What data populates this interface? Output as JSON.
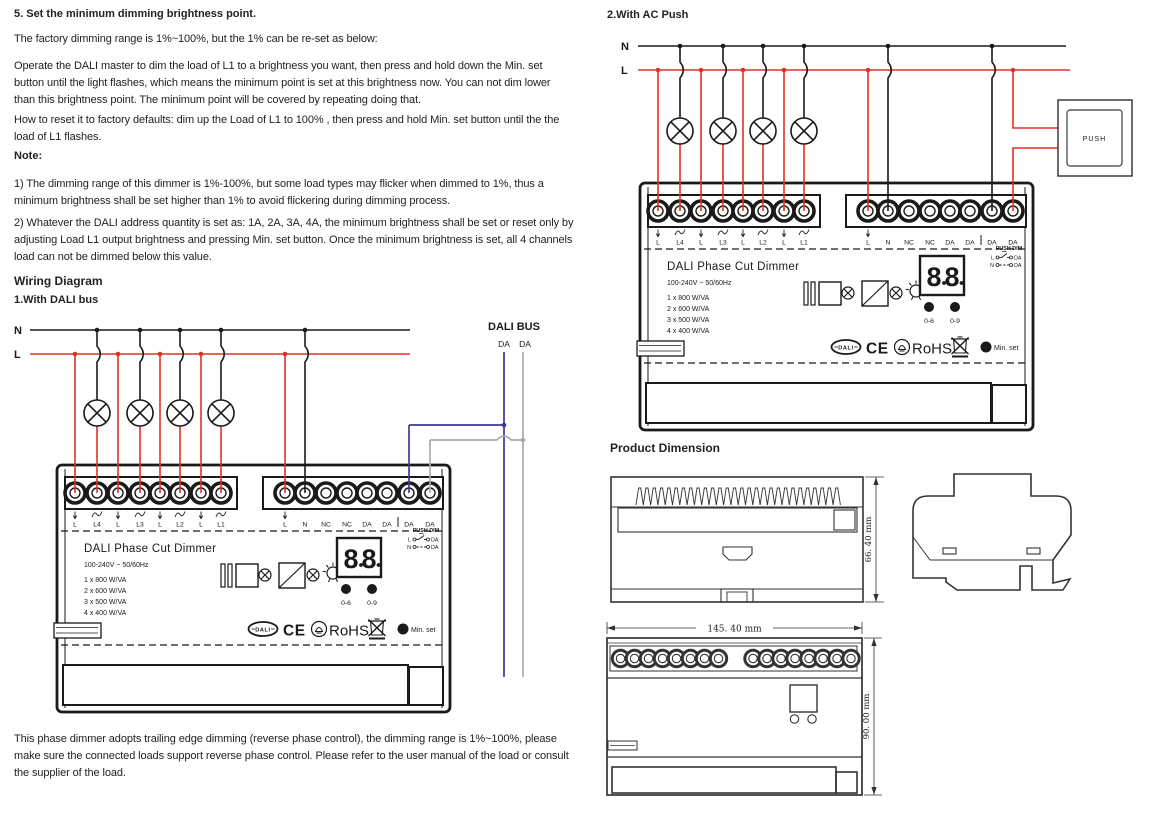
{
  "section5": {
    "heading": "5. Set the minimum dimming brightness point.",
    "para1": "The factory dimming range is 1%~100%, but the 1% can be re-set as below:",
    "para2": "Operate the DALI master to dim the load of L1 to a brightness you want, then press and hold down the Min. set button until the light flashes, which means the minimum point is set at this brightness now. You can not dim lower than this brightness point. The minimum point will be covered by repeating doing that.",
    "para3": "How to reset it to factory defaults: dim up the Load of L1 to 100% , then press and hold Min. set button until the the load of L1 flashes.",
    "note_heading": "Note:",
    "note1": "1) The dimming range of this dimmer is 1%-100%, but some load types may flicker when dimmed to 1%, thus a minimum brightness shall be set higher than 1% to avoid flickering during dimming process.",
    "note2": "2) Whatever the DALI address quantity is set as: 1A, 2A, 3A, 4A,  the minimum brightness shall be set or reset only by adjusting Load L1 output brightness and pressing Min. set button. Once the minimum brightness is set, all 4 channels load can not be dimmed below this value."
  },
  "wiring": {
    "heading": "Wiring Diagram",
    "sub1": "1.With DALI bus",
    "sub2": "2.With AC Push",
    "line_n": "N",
    "line_l": "L",
    "bus_label": "DALI BUS",
    "bus_terminals": [
      "DA",
      "DA"
    ],
    "push_label": "PUSH"
  },
  "device": {
    "title": "DALI Phase Cut Dimmer",
    "rating": "100-240V ~  50/60Hz",
    "loads": [
      "1 x 800 W/VA",
      "2 x 600 W/VA",
      "3 x 500 W/VA",
      "4 x 400 W/VA"
    ],
    "terminals_left": [
      "L",
      "L4",
      "L",
      "L3",
      "L",
      "L2",
      "L",
      "L1"
    ],
    "terminals_right": [
      "L",
      "N",
      "NC",
      "NC",
      "DA",
      "DA",
      "DA",
      "DA"
    ],
    "display": "8.8.",
    "btn_left": "0-6",
    "btn_right": "0-9",
    "push_dim": {
      "title": "PUSH DIM",
      "row1_l": "L",
      "row1_r": "DA",
      "row2_l": "N",
      "row2_r": "DA"
    },
    "logo_dali": "DALI",
    "logo_ce": "CE",
    "logo_rohs": "RoHS",
    "min_set": "Min. set"
  },
  "dimension": {
    "heading": "Product Dimension",
    "width_label": "145. 40 mm",
    "side_height_label": "66. 40 mm",
    "front_height_label": "90. 00 mm"
  },
  "footer": "This phase dimmer adopts trailing edge dimming (reverse phase control), the dimming range is 1%~100%, please make sure the connected loads support reverse phase control. Please refer to the user manual of the load or consult the supplier of the load.",
  "colors": {
    "wire_live": "#e03127",
    "wire_neutral": "#1a1a1a",
    "wire_dali_blue": "#3a3a9e",
    "wire_dali_gray": "#ababab",
    "ink": "#1a1a1a"
  }
}
